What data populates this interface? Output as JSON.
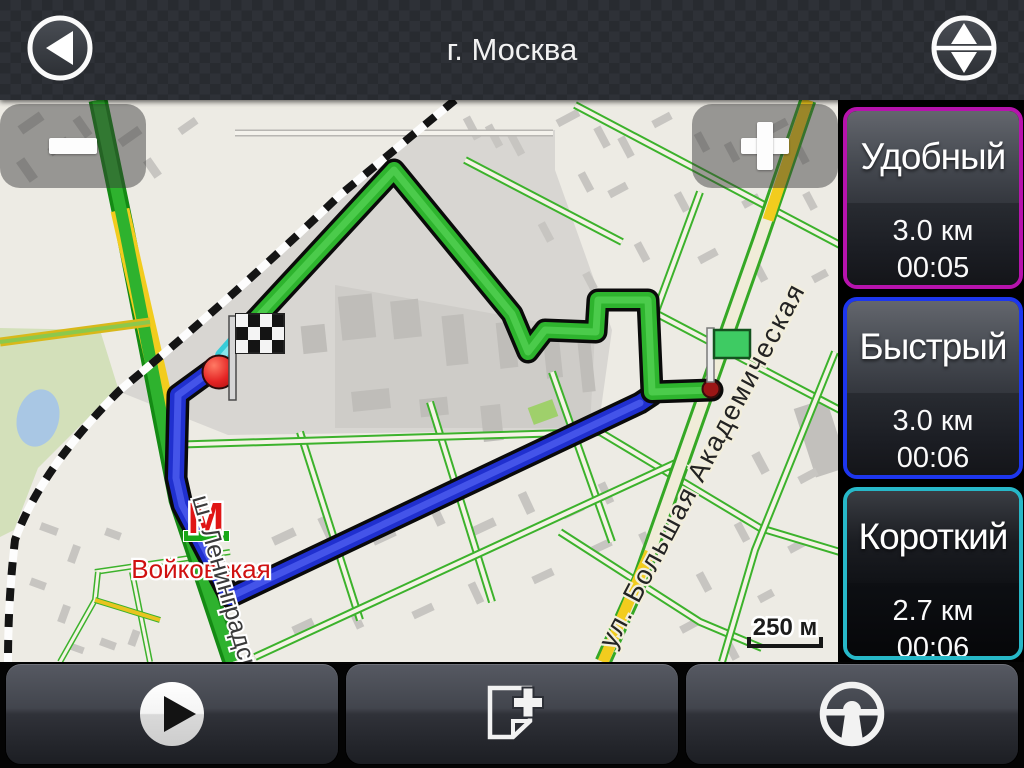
{
  "header": {
    "title": "г. Москва"
  },
  "map": {
    "scale_label": "250 м",
    "metro_letter": "М",
    "station_label": "Войковская",
    "street_label_vertical": "ш. Ленинградское",
    "street_label_diagonal": "ул. Большая Академическая",
    "route_line_colors": {
      "green_route": "#2eb42e",
      "blue_route": "#2030cf",
      "finish_transition": "#38ccd8"
    },
    "markers": {
      "finish": "checkered-flag",
      "start": "green-flag"
    }
  },
  "route_options": [
    {
      "name": "Удобный",
      "distance": "3.0 км",
      "duration": "00:05",
      "accent_color": "#b713ad"
    },
    {
      "name": "Быстрый",
      "distance": "3.0 км",
      "duration": "00:06",
      "accent_color": "#1d36ee"
    },
    {
      "name": "Короткий",
      "distance": "2.7 км",
      "duration": "00:06",
      "accent_color": "#27b8c8"
    }
  ],
  "toolbar_icons": [
    "play",
    "add-waypoint",
    "steering-wheel"
  ],
  "header_icons": [
    "back-arrow",
    "reorder-routes"
  ]
}
